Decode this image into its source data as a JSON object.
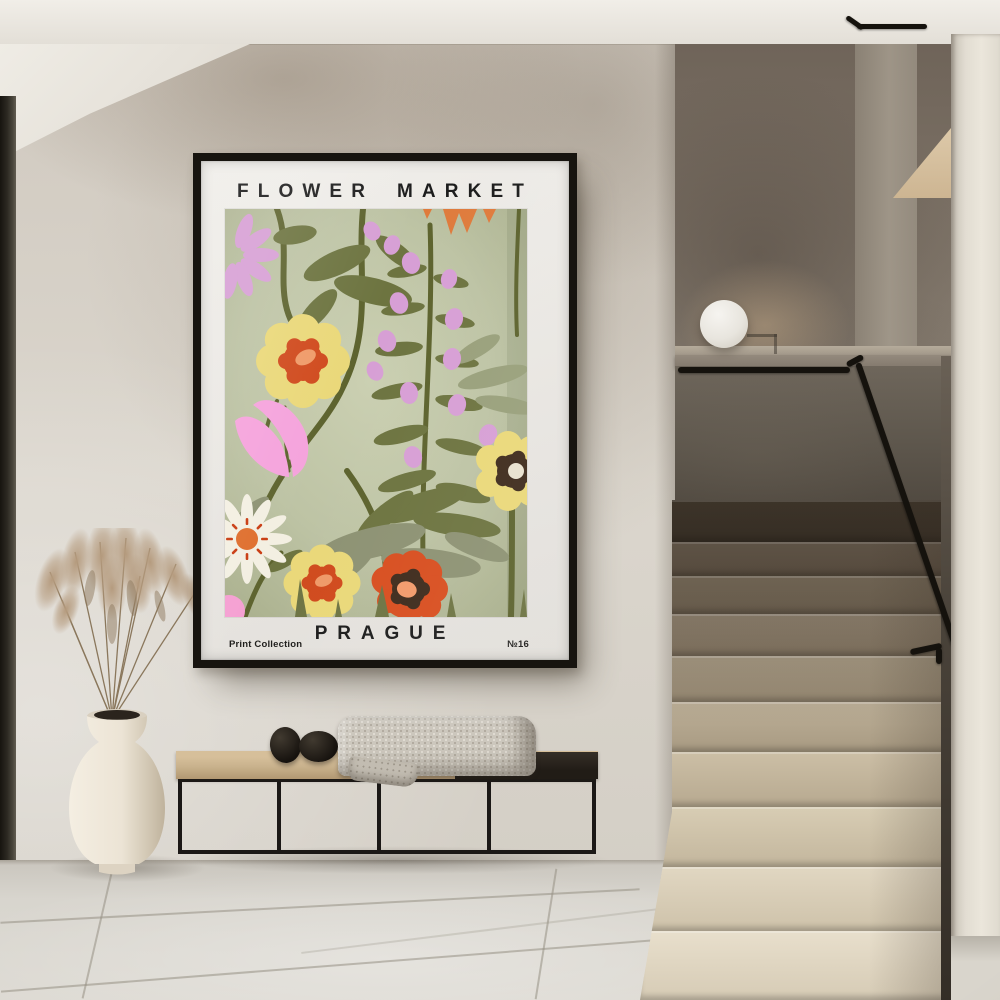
{
  "poster": {
    "title": "FLOWER MARKET",
    "city": "PRAGUE",
    "caption_left": "Print Collection",
    "caption_right": "№16",
    "frame_color": "#17140f",
    "matte_color": "#eae8e4",
    "art_palette": {
      "background_center": "#cbd0b2",
      "background_edge": "#a9af8c",
      "olive": "#6d7440",
      "dark_olive_stem": "#5d632e",
      "sage": "#8d9273",
      "light_sage": "#99a07b",
      "pink": "#d79fd5",
      "bright_pink": "#f5a3dc",
      "yellow": "#ead879",
      "orange_red": "#d04a1d",
      "peach": "#ef9a68",
      "poppy_red": "#d84e1f",
      "dark_brown": "#3e2b1c",
      "daisy_white": "#f3efe2",
      "daisy_center_orange": "#df6f2e",
      "spike_orange": "#df7b3c"
    }
  },
  "scene": {
    "wall_color": "#d6d0c7",
    "stairwell_wall_color": "#857c70",
    "floor_color": "#d8d5ce",
    "step_color_top": "#6f6252",
    "step_color_bottom": "#e8dfcc",
    "bench_seat_color": "#c9b28d",
    "bench_dark_top_color": "#26211b",
    "bench_frame_color": "#1b1816",
    "blanket_color": "#ccc7bd",
    "pebble_color": "#1f1b17",
    "vase_color": "#ece5d8",
    "pampas_color": "#b49a7e",
    "lamp_color": "#edeae4",
    "handrail_color": "#15120d",
    "door_frame_color": "#2c2922",
    "objects": [
      "framed flower market poster",
      "dried pampas grass in cream floor vase",
      "black metal frame bench",
      "knit throw blanket",
      "two black stone decor objects",
      "white sphere lamp on ledge",
      "terrazzo staircase",
      "black handrail",
      "large tile stone floor"
    ]
  }
}
